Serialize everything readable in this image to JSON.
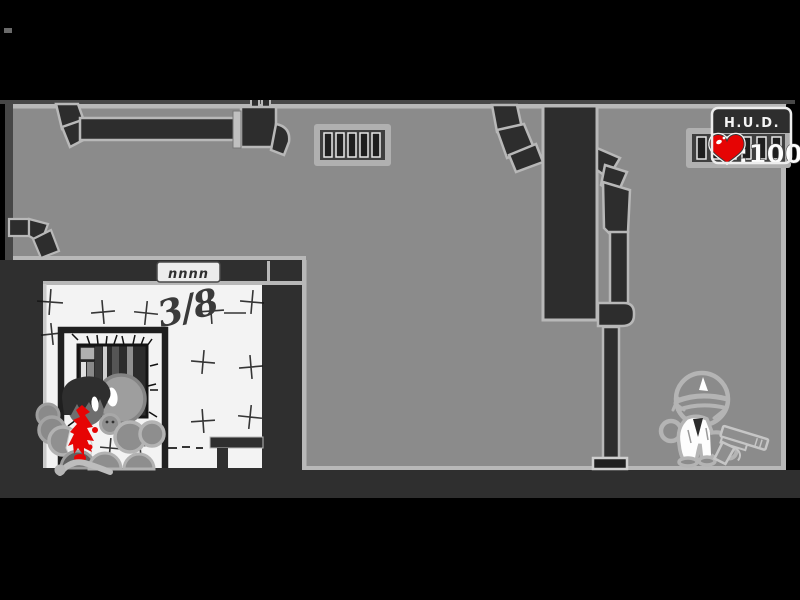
{
  "hud": {
    "title": "H.U.D.",
    "health_value": "100",
    "health_display": ":100",
    "heart_icon": "heart-icon",
    "heart_color": "#e60404"
  },
  "closet": {
    "wall_counter": "3/8",
    "vent_marks": "nnnn"
  },
  "colors": {
    "background": "#000000",
    "wall_gray": "#8b8b8b",
    "wall_outline": "#b8b8b8",
    "structure_dark": "#2d2d2d",
    "closet_surround": "#2f2f2f",
    "closet_wall_white": "#f3f3f3",
    "blood_red": "#e60404",
    "hud_text": "#ffffff"
  }
}
